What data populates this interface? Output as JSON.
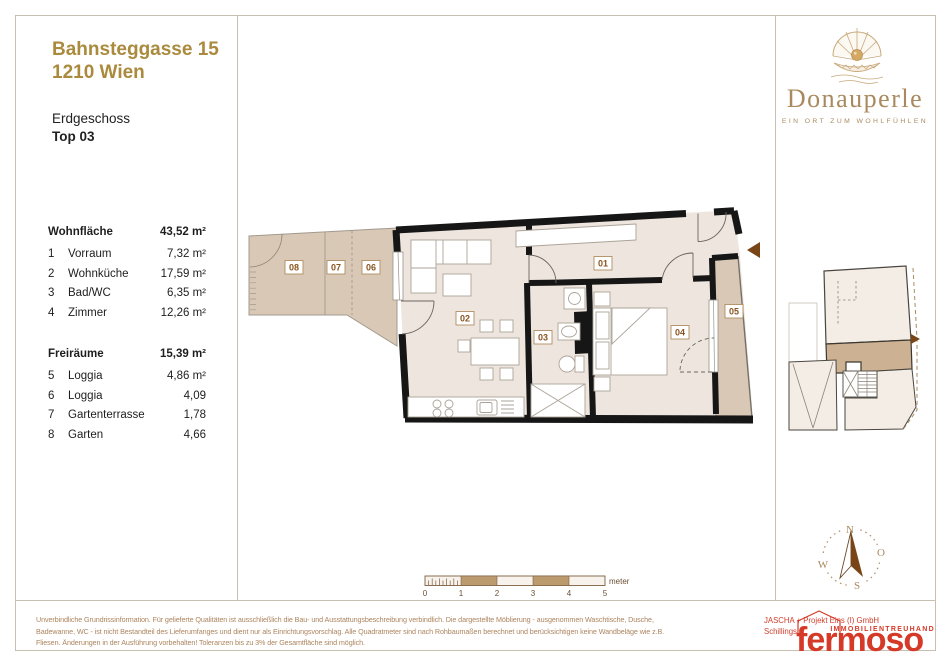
{
  "header": {
    "address_line1": "Bahnsteggasse 15",
    "address_line2": "1210 Wien",
    "floor": "Erdgeschoss",
    "unit": "Top 03"
  },
  "brand": {
    "name": "Donauperle",
    "tagline": "EIN ORT ZUM WOHLFÜHLEN"
  },
  "area_table": {
    "living": {
      "label": "Wohnfläche",
      "value": "43,52 m²",
      "rows": [
        {
          "num": "1",
          "name": "Vorraum",
          "value": "7,32 m²"
        },
        {
          "num": "2",
          "name": "Wohnküche",
          "value": "17,59 m²"
        },
        {
          "num": "3",
          "name": "Bad/WC",
          "value": "6,35 m²"
        },
        {
          "num": "4",
          "name": "Zimmer",
          "value": "12,26 m²"
        }
      ]
    },
    "open": {
      "label": "Freiräume",
      "value": "15,39 m²",
      "rows": [
        {
          "num": "5",
          "name": "Loggia",
          "value": "4,86 m²"
        },
        {
          "num": "6",
          "name": "Loggia",
          "value": "4,09"
        },
        {
          "num": "7",
          "name": "Gartenterrasse",
          "value": "1,78"
        },
        {
          "num": "8",
          "name": "Garten",
          "value": "4,66"
        }
      ]
    }
  },
  "plan": {
    "room_labels": [
      "01",
      "02",
      "03",
      "04",
      "05",
      "06",
      "07",
      "08"
    ]
  },
  "scalebar": {
    "ticks": [
      "0",
      "1",
      "2",
      "3",
      "4",
      "5"
    ],
    "unit": "meter"
  },
  "compass": {
    "north": "N",
    "east": "O",
    "south": "S",
    "west": "W"
  },
  "footer": {
    "disclaimer_lines": [
      "Unverbindliche Grundrissinformation. Für gelieferte Qualitäten ist ausschließlich die Bau- und Ausstattungsbeschreibung verbindlich. Die dargestellte Möblierung - ausgenommen Waschtische, Dusche,",
      "Badewanne, WC - ist nicht Bestandteil des Lieferumfanges und dient nur als Einrichtungsvorschlag. Alle Quadratmeter sind nach Rohbaumaßen berechnet und berücksichtigen keine Wandbeläge wie z.B.",
      "Fliesen. Änderungen in der Ausführung vorbehalten! Toleranzen bis zu 3% der Gesamtfläche sind möglich."
    ],
    "company_line1": "JASCHA + Projekt Eins (I) GmbH",
    "company_line2": "Schillings",
    "logo_text": "fermoso",
    "logo_subtext": "IMMOBILIENTREUHAND"
  },
  "colors": {
    "title_gold": "#aa8a3c",
    "brand_tan": "#a98a5f",
    "wall_black": "#161616",
    "indoor_fill": "#eee6de",
    "outdoor_fill": "#d9c8b5",
    "minimap_highlight": "#ccb293",
    "logo_red": "#d53a28",
    "arrow_brown": "#7a4516"
  }
}
